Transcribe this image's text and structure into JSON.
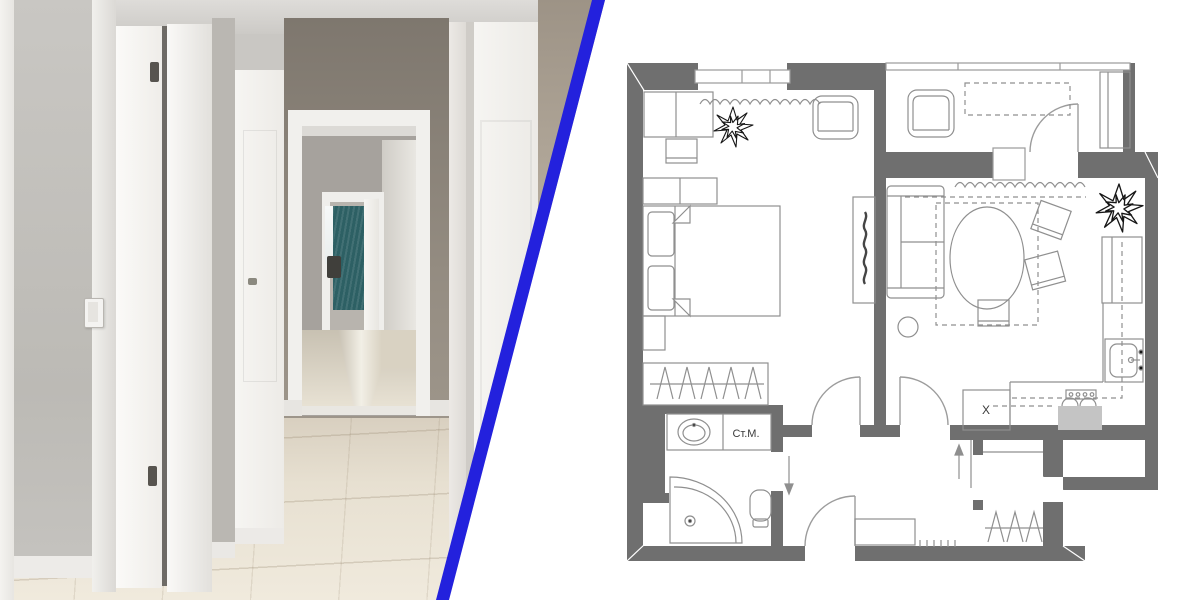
{
  "divider": {
    "color": "#2321dd"
  },
  "photo": {
    "palette": {
      "ceiling": "#d8d6d3",
      "left_wall": "#c7c4c0",
      "feature_wall": "#898177",
      "inner_wall": "#a5a09b",
      "accent_wallpaper": "#2d6064",
      "trim_white": "#f3f2ef",
      "floor_wood": "#e2dacb"
    }
  },
  "floorplan": {
    "colors": {
      "wall": "#6f6f6f",
      "line": "#8f8f8f",
      "door_line": "#9c9c9c",
      "dash": "#a8a8a8",
      "stove_fill": "#c4c4c4",
      "plant": "#161616",
      "label_text": "#3a3a3a"
    },
    "labels": {
      "washing_machine": "Ст.М.",
      "marked_unit": "X"
    }
  }
}
